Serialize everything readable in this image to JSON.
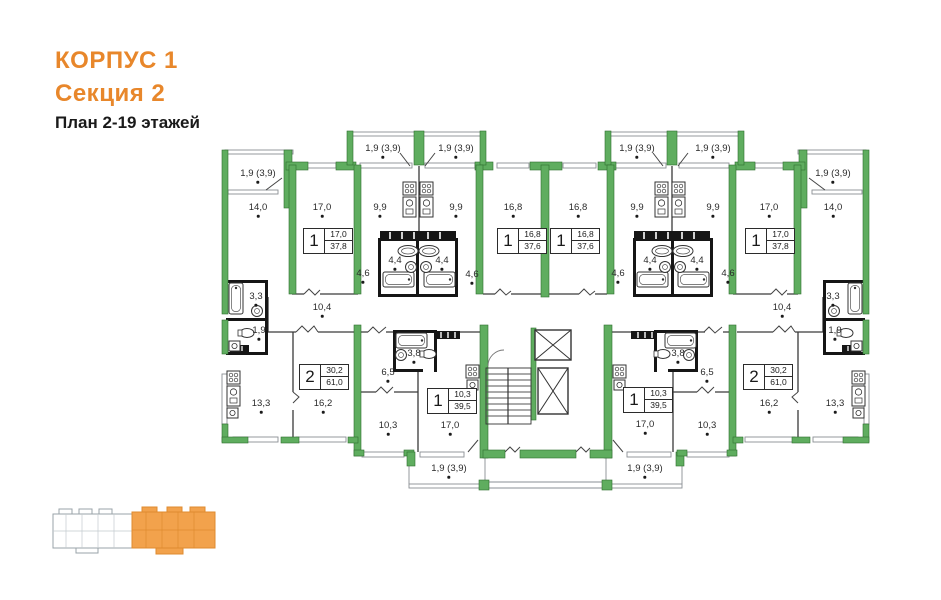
{
  "header": {
    "building": "КОРПУС 1",
    "section": "Секция 2",
    "plan": "План 2-19 этажей"
  },
  "colors": {
    "accent_orange": "#E8872B",
    "wall_green": "#5FAD5F",
    "keyplan_highlight": "#F2A24C"
  },
  "plan": {
    "room_labels": [
      {
        "text": "1,9 (3,9)",
        "x": 258,
        "y": 176
      },
      {
        "text": "14,0",
        "x": 258,
        "y": 210
      },
      {
        "text": "17,0",
        "x": 322,
        "y": 210
      },
      {
        "text": "1,9 (3,9)",
        "x": 383,
        "y": 151
      },
      {
        "text": "9,9",
        "x": 380,
        "y": 210
      },
      {
        "text": "1,9 (3,9)",
        "x": 456,
        "y": 151
      },
      {
        "text": "9,9",
        "x": 456,
        "y": 210
      },
      {
        "text": "16,8",
        "x": 513,
        "y": 210
      },
      {
        "text": "16,8",
        "x": 578,
        "y": 210
      },
      {
        "text": "1,9 (3,9)",
        "x": 637,
        "y": 151
      },
      {
        "text": "9,9",
        "x": 637,
        "y": 210
      },
      {
        "text": "1,9 (3,9)",
        "x": 713,
        "y": 151
      },
      {
        "text": "9,9",
        "x": 713,
        "y": 210
      },
      {
        "text": "17,0",
        "x": 769,
        "y": 210
      },
      {
        "text": "1,9 (3,9)",
        "x": 833,
        "y": 176
      },
      {
        "text": "14,0",
        "x": 833,
        "y": 210
      },
      {
        "text": "4,4",
        "x": 395,
        "y": 263
      },
      {
        "text": "4,4",
        "x": 442,
        "y": 263
      },
      {
        "text": "4,6",
        "x": 363,
        "y": 276
      },
      {
        "text": "4,6",
        "x": 472,
        "y": 277
      },
      {
        "text": "4,4",
        "x": 650,
        "y": 263
      },
      {
        "text": "4,4",
        "x": 697,
        "y": 263
      },
      {
        "text": "4,6",
        "x": 618,
        "y": 276
      },
      {
        "text": "4,6",
        "x": 728,
        "y": 276
      },
      {
        "text": "3,3",
        "x": 256,
        "y": 299
      },
      {
        "text": "1,9",
        "x": 259,
        "y": 333
      },
      {
        "text": "10,4",
        "x": 322,
        "y": 310
      },
      {
        "text": "10,4",
        "x": 782,
        "y": 310
      },
      {
        "text": "3,3",
        "x": 833,
        "y": 299
      },
      {
        "text": "1,9",
        "x": 835,
        "y": 333
      },
      {
        "text": "13,3",
        "x": 261,
        "y": 406
      },
      {
        "text": "16,2",
        "x": 323,
        "y": 406
      },
      {
        "text": "6,5",
        "x": 388,
        "y": 375
      },
      {
        "text": "3,8",
        "x": 414,
        "y": 356
      },
      {
        "text": "10,3",
        "x": 388,
        "y": 428
      },
      {
        "text": "17,0",
        "x": 450,
        "y": 428
      },
      {
        "text": "1,9 (3,9)",
        "x": 449,
        "y": 471
      },
      {
        "text": "3,8",
        "x": 678,
        "y": 356
      },
      {
        "text": "6,5",
        "x": 707,
        "y": 375
      },
      {
        "text": "17,0",
        "x": 645,
        "y": 427
      },
      {
        "text": "10,3",
        "x": 707,
        "y": 428
      },
      {
        "text": "16,2",
        "x": 769,
        "y": 406
      },
      {
        "text": "13,3",
        "x": 835,
        "y": 406
      },
      {
        "text": "1,9 (3,9)",
        "x": 645,
        "y": 471
      }
    ],
    "apartment_cards": [
      {
        "rooms": "1",
        "living": "17,0",
        "total": "37,8",
        "x": 328,
        "y": 241
      },
      {
        "rooms": "1",
        "living": "16,8",
        "total": "37,6",
        "x": 522,
        "y": 241
      },
      {
        "rooms": "1",
        "living": "16,8",
        "total": "37,6",
        "x": 575,
        "y": 241
      },
      {
        "rooms": "1",
        "living": "17,0",
        "total": "37,8",
        "x": 770,
        "y": 241
      },
      {
        "rooms": "2",
        "living": "30,2",
        "total": "61,0",
        "x": 324,
        "y": 377
      },
      {
        "rooms": "1",
        "living": "10,3",
        "total": "39,5",
        "x": 452,
        "y": 401
      },
      {
        "rooms": "1",
        "living": "10,3",
        "total": "39,5",
        "x": 648,
        "y": 400
      },
      {
        "rooms": "2",
        "living": "30,2",
        "total": "61,0",
        "x": 768,
        "y": 377
      }
    ]
  },
  "keyplan": {
    "sections": 2,
    "highlighted_section": "right"
  }
}
